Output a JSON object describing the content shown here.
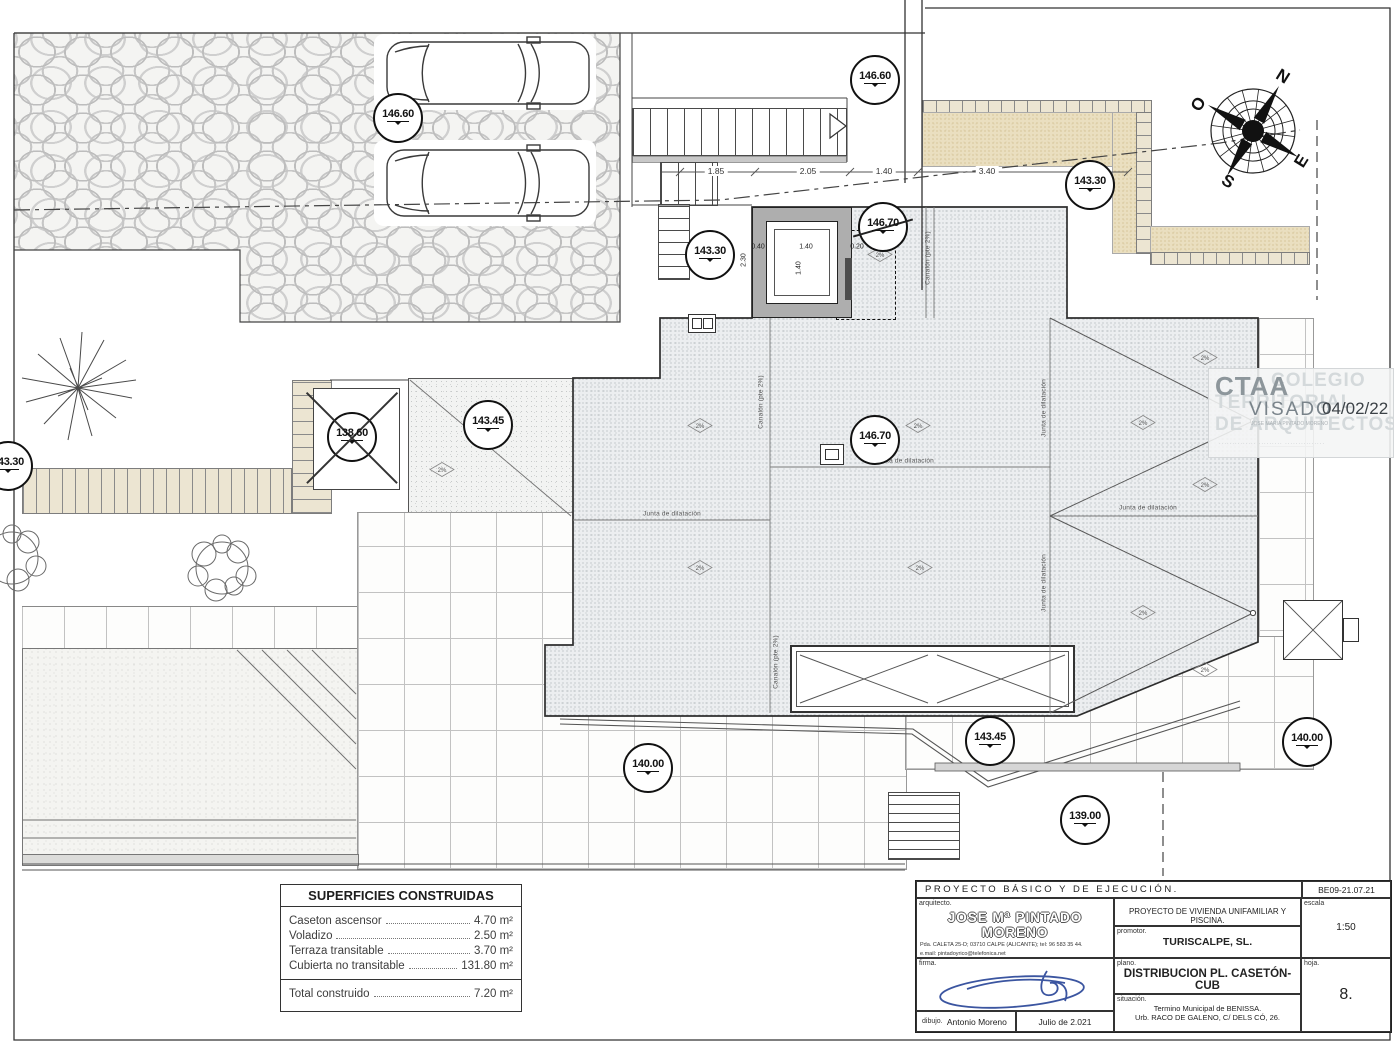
{
  "drawing": {
    "levels": [
      {
        "value": "146.60"
      },
      {
        "value": "146.60"
      },
      {
        "value": "143.30"
      },
      {
        "value": "146.70"
      },
      {
        "value": "143.30"
      },
      {
        "value": "138.60"
      },
      {
        "value": "143.45"
      },
      {
        "value": "146.70"
      },
      {
        "value": "143.30"
      },
      {
        "value": "140.00"
      },
      {
        "value": "143.45"
      },
      {
        "value": "140.00"
      },
      {
        "value": "139.00"
      }
    ],
    "stair_dims": [
      "1.85",
      "2.05",
      "1.40",
      "3.40"
    ],
    "shaft_dims": {
      "left_wall": "0.40",
      "inner": "1.40",
      "right_wall": "0.20",
      "inner_v": "1.40",
      "outer_v": "2.30"
    },
    "annotations": {
      "junta": "Junta de dilatación",
      "canalon": "Canalón (pte 2%)",
      "slope": "2%"
    },
    "compass": {
      "n": "N",
      "o": "O",
      "e": "E",
      "s": "S"
    }
  },
  "stamp": {
    "acronym": "CTAA",
    "word1": "COLEGIO",
    "word2": "TERRITORIAL",
    "word3": "DE ARQUITECTOS",
    "visado": "VISADO",
    "date": "04/02/22",
    "small1": "JOSE MARIA PINTADO MORENO",
    "small2": "·············· ········· ···············"
  },
  "areas": {
    "title": "SUPERFICIES CONSTRUIDAS",
    "rows": [
      {
        "label": "Caseton ascensor",
        "value": "4.70 m²"
      },
      {
        "label": "Voladizo",
        "value": "2.50 m²"
      },
      {
        "label": "Terraza transitable",
        "value": "3.70 m²"
      },
      {
        "label": "Cubierta no transitable",
        "value": "131.80 m²"
      }
    ],
    "total": {
      "label": "Total construido",
      "value": "7.20 m²"
    }
  },
  "titleblock": {
    "project_type": "PROYECTO BÁSICO Y DE EJECUCIÓN.",
    "code": "BE09-21.07.21",
    "arquitecto_label": "arquitecto.",
    "architect": "JOSE Mª PINTADO MORENO",
    "address1": "Pda. CALETA 25-D; 03710 CALPE (ALICANTE); tel: 96 583 35 44.",
    "address2": "e.mail:  pintadoyrico@telefonica.net",
    "firma_label": "firma.",
    "dibujo_label": "dibujo.",
    "dibujo": "Antonio Moreno",
    "fecha": "Julio de 2.021",
    "project_title": "PROYECTO DE VIVIENDA UNIFAMILIAR Y PISCINA.",
    "promotor_label": "promotor.",
    "promotor": "TURISCALPE, SL.",
    "plano_label": "plano.",
    "plano": "DISTRIBUCION PL. CASETÓN-CUB",
    "situacion_label": "situación.",
    "situacion1": "Termino Municipal de BENISSA.",
    "situacion2": "Urb. RACO DE GALENO, C/ DELS CÓ, 26.",
    "escala_label": "escala",
    "escala": "1:50",
    "hoja_label": "hoja.",
    "hoja": "8."
  }
}
